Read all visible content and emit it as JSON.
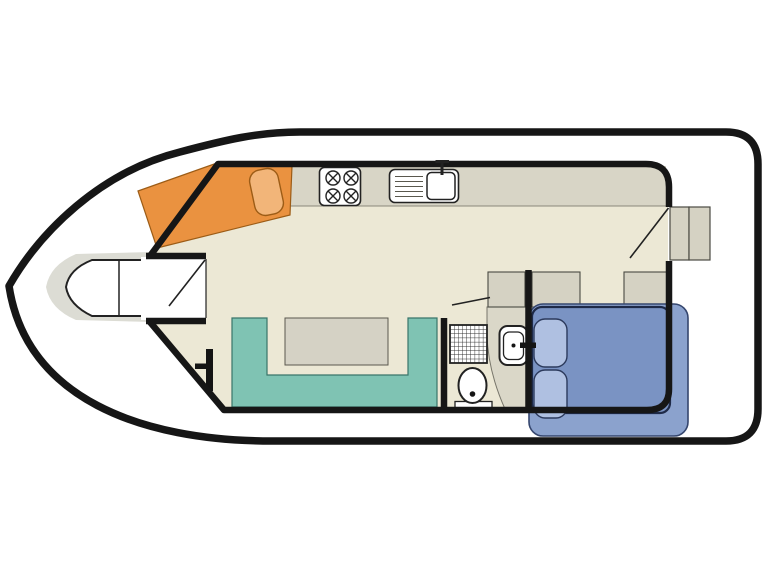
{
  "diagram": {
    "type": "houseboat-floorplan",
    "orientation": "bow-left",
    "canvas": {
      "width": 768,
      "height": 576,
      "background": "#ffffff"
    },
    "items": [
      {
        "name": "hull",
        "description": "boat hull outline, pointed bow at left, squared stern at right"
      },
      {
        "name": "bow-deck",
        "description": "grey foredeck platform at bow"
      },
      {
        "name": "bow-seat",
        "description": "white pointed bow bench with divider"
      },
      {
        "name": "bow-entry",
        "description": "front entry niche with open door"
      },
      {
        "name": "helm-berth",
        "description": "angled orange single berth with pillow at front cabin"
      },
      {
        "name": "galley-counter",
        "description": "grey worktop along top wall"
      },
      {
        "name": "hob",
        "description": "4-burner stove on worktop"
      },
      {
        "name": "sink",
        "description": "sink with drainer and tap on worktop"
      },
      {
        "name": "steering-position",
        "description": "T-shaped helm symbol beside dinette"
      },
      {
        "name": "dinette",
        "description": "teal U-shaped sofa with table"
      },
      {
        "name": "shower",
        "description": "shower tray with grid hatching"
      },
      {
        "name": "toilet",
        "description": "toilet bowl with cistern base"
      },
      {
        "name": "washbasin",
        "description": "washbasin on curved vanity"
      },
      {
        "name": "wardrobes",
        "description": "three grey storage cabinets"
      },
      {
        "name": "double-bed",
        "description": "blue double bed with two pillows, shown part-extended"
      },
      {
        "name": "aft-steps",
        "description": "two steps to aft deck through side door"
      }
    ],
    "counts": {
      "burners": 4,
      "bed_pillows": 2,
      "steps": 2,
      "wardrobes": 3
    }
  },
  "colors": {
    "background": "#ffffff",
    "hull_outline": "#161616",
    "wall": "#161616",
    "floor": "#ece8d5",
    "counter": "#d8d5c6",
    "counter_edge": "#8a887a",
    "foredeck": "#dcdcd4",
    "white": "#ffffff",
    "fixture_outline": "#222222",
    "sofa_teal": "#7fc3b3",
    "sofa_outline": "#39756a",
    "table_gray": "#d5d2c5",
    "gray_outline": "#5a584e",
    "cabinet_gray": "#d5d2c3",
    "cabinet_outline": "#4a4a42",
    "vanity_gray": "#dad7c8",
    "vanity_outline": "#77756a",
    "berth_orange": "#ea9240",
    "berth_outline": "#9c5c16",
    "berth_pillow": "#f2b579",
    "bed_outer": "#8ba2cd",
    "bed_inner": "#7a93c3",
    "bed_outline": "#1e2a48",
    "bed_outer_outline": "#35466e",
    "bed_pillow": "#afc0e1",
    "bed_pillow_outline": "#2c3a5c",
    "grid_line": "#2a2a2a",
    "black_item": "#141414"
  }
}
